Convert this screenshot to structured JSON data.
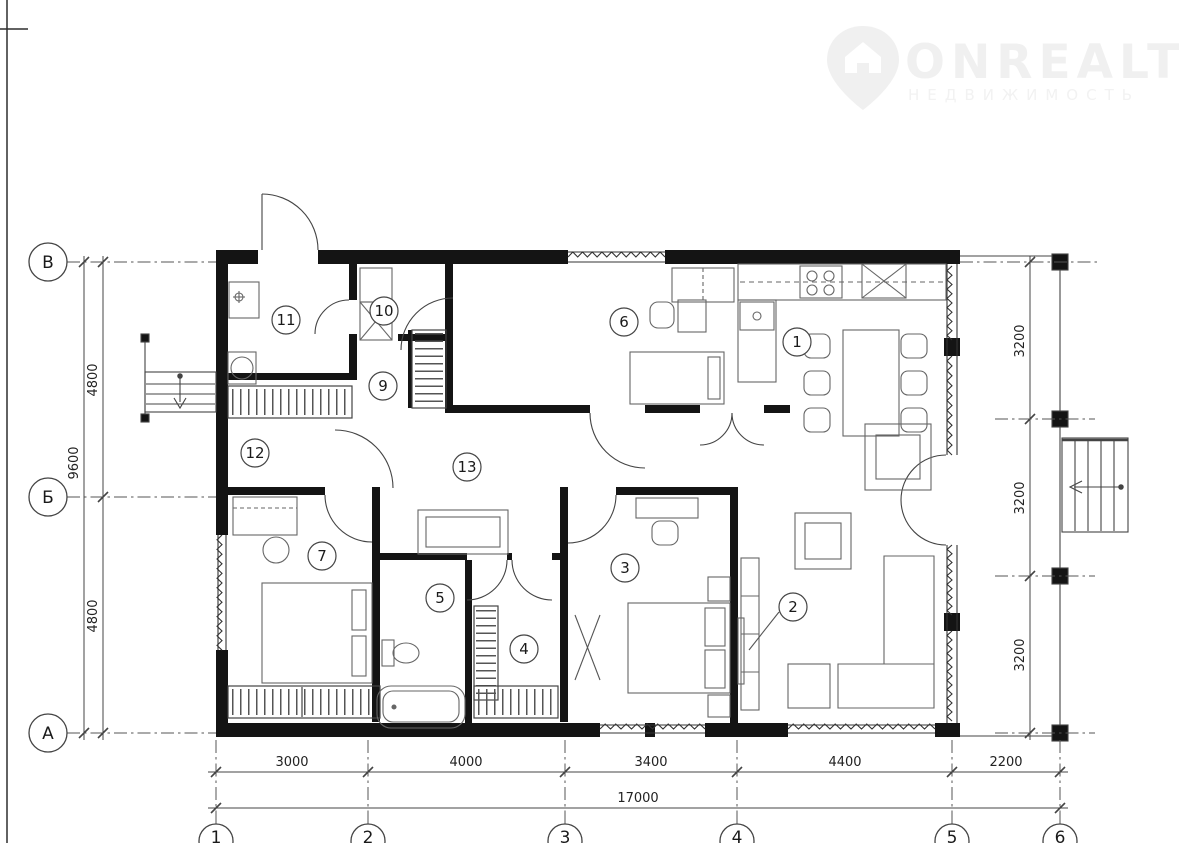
{
  "watermark": {
    "brand": "ONREALT",
    "subtitle": "НЕДВИЖИМОСТЬ"
  },
  "rooms": {
    "r1": "1",
    "r2": "2",
    "r3": "3",
    "r4": "4",
    "r5": "5",
    "r6": "6",
    "r7": "7",
    "r9": "9",
    "r10": "10",
    "r11": "11",
    "r12": "12",
    "r13": "13"
  },
  "axes": {
    "left": [
      "В",
      "Б",
      "А"
    ],
    "bottom": [
      "1",
      "2",
      "3",
      "4",
      "5",
      "6"
    ]
  },
  "dims": {
    "bottom": [
      "3000",
      "4000",
      "3400",
      "4400",
      "2200"
    ],
    "bottom_total": "17000",
    "left": [
      "4800",
      "4800"
    ],
    "left_total": "9600",
    "right": [
      "3200",
      "3200",
      "3200"
    ]
  }
}
